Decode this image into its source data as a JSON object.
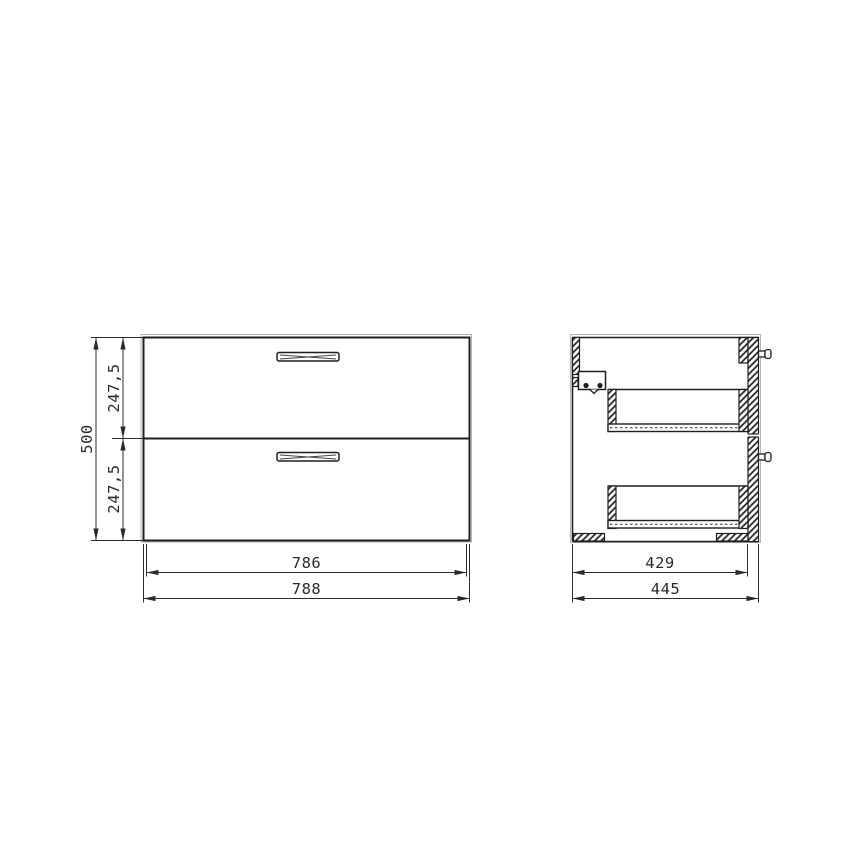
{
  "colors": {
    "line": "#1f1f1f",
    "dimension": "#2b2b2b",
    "background": "#ffffff",
    "ghost_line": "#b5b5b5"
  },
  "front_view": {
    "dims": {
      "total_height": "500",
      "upper_drawer_height": "247,5",
      "lower_drawer_height": "247,5",
      "front_width": "786",
      "body_width": "788"
    }
  },
  "side_view": {
    "dims": {
      "inner_depth": "429",
      "total_depth": "445"
    }
  }
}
